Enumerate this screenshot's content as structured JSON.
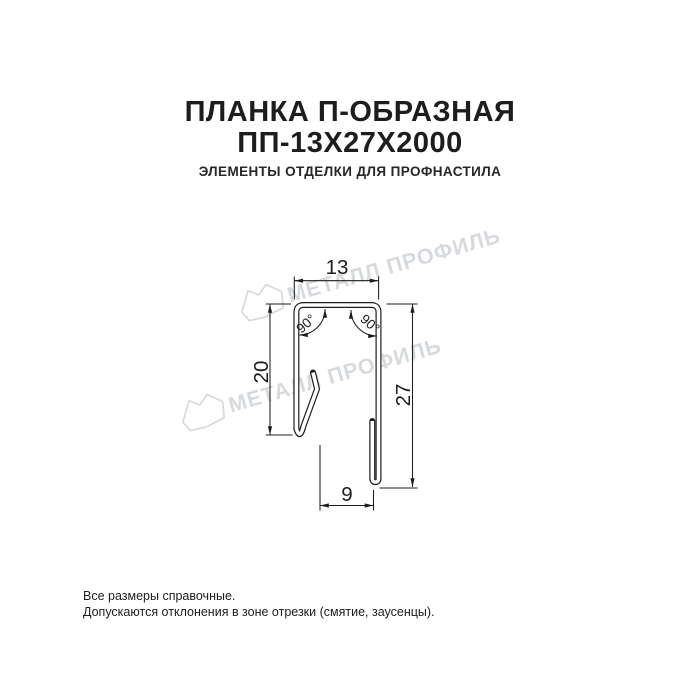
{
  "header": {
    "title_line1": "ПЛАНКА П-ОБРАЗНАЯ",
    "title_line2": "ПП-13Х27Х2000",
    "subtitle": "ЭЛЕМЕНТЫ ОТДЕЛКИ ДЛЯ ПРОФНАСТИЛА"
  },
  "drawing": {
    "dimensions": {
      "top_width": "13",
      "left_height": "20",
      "right_height": "27",
      "bottom_width": "9",
      "angle_left": "90°",
      "angle_right": "90°"
    },
    "watermark_text": "МЕТАЛЛ ПРОФИЛЬ"
  },
  "footer": {
    "line1": "Все размеры справочные.",
    "line2": "Допускаются отклонения в зоне отрезки (смятие, заусенцы)."
  },
  "colors": {
    "ink": "#1d1d1b",
    "watermark": "#d7dadd",
    "background": "#ffffff"
  }
}
